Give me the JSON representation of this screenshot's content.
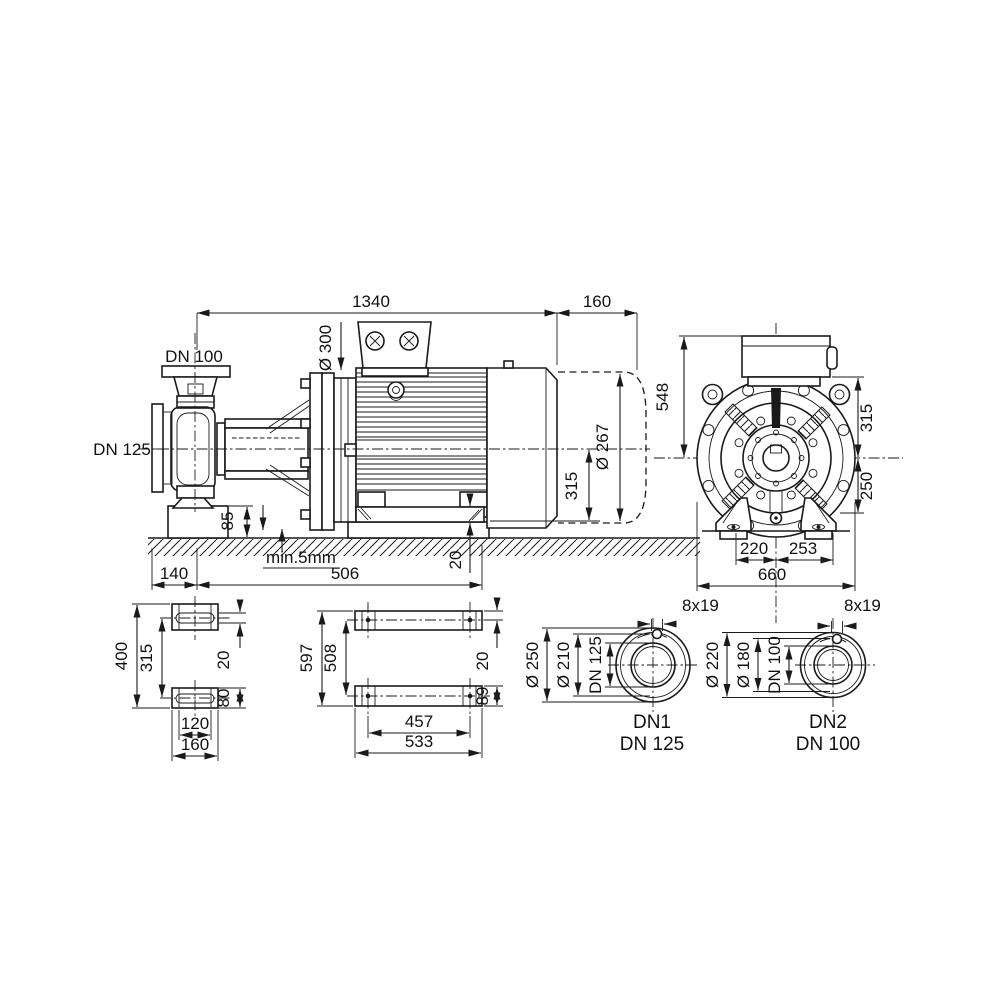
{
  "drawing": {
    "side_view": {
      "dim_total_length": "1340",
      "dim_removal_space": "160",
      "dim_flange_diameter": "Ø 300",
      "label_discharge": "DN 100",
      "label_suction": "DN 125",
      "dim_motor_diameter": "Ø 267",
      "dim_shaft_height": "315",
      "dim_foundation_height": "85",
      "note_grout": "min.5mm",
      "dim_suction_offset": "140",
      "dim_foot_distance": "506",
      "dim_baseplate_thickness": "20"
    },
    "front_view": {
      "dim_height_top": "548",
      "dim_center_to_top": "315",
      "dim_center_to_foot": "250",
      "dim_foot_left": "220",
      "dim_foot_right": "253",
      "dim_width": "660"
    },
    "pump_feet_plan": {
      "dim_overall": "400",
      "dim_centers": "315",
      "dim_slot_width": "20",
      "dim_foot_width": "80",
      "dim_inner_width": "120",
      "dim_outer_width": "160"
    },
    "motor_feet_plan": {
      "dim_overall": "597",
      "dim_centers": "508",
      "dim_hole_offset": "20",
      "dim_foot_width": "89",
      "dim_hole_distance": "457",
      "dim_outer_width": "533"
    },
    "flange_dn1": {
      "bolt_holes": "8x19",
      "dim_outer": "Ø 250",
      "dim_bolt_circle": "Ø 210",
      "dim_bore": "DN 125",
      "port_id": "DN1",
      "port_size": "DN 125"
    },
    "flange_dn2": {
      "bolt_holes": "8x19",
      "dim_outer": "Ø 220",
      "dim_bolt_circle": "Ø 180",
      "dim_bore": "DN 100",
      "port_id": "DN2",
      "port_size": "DN 100"
    }
  }
}
